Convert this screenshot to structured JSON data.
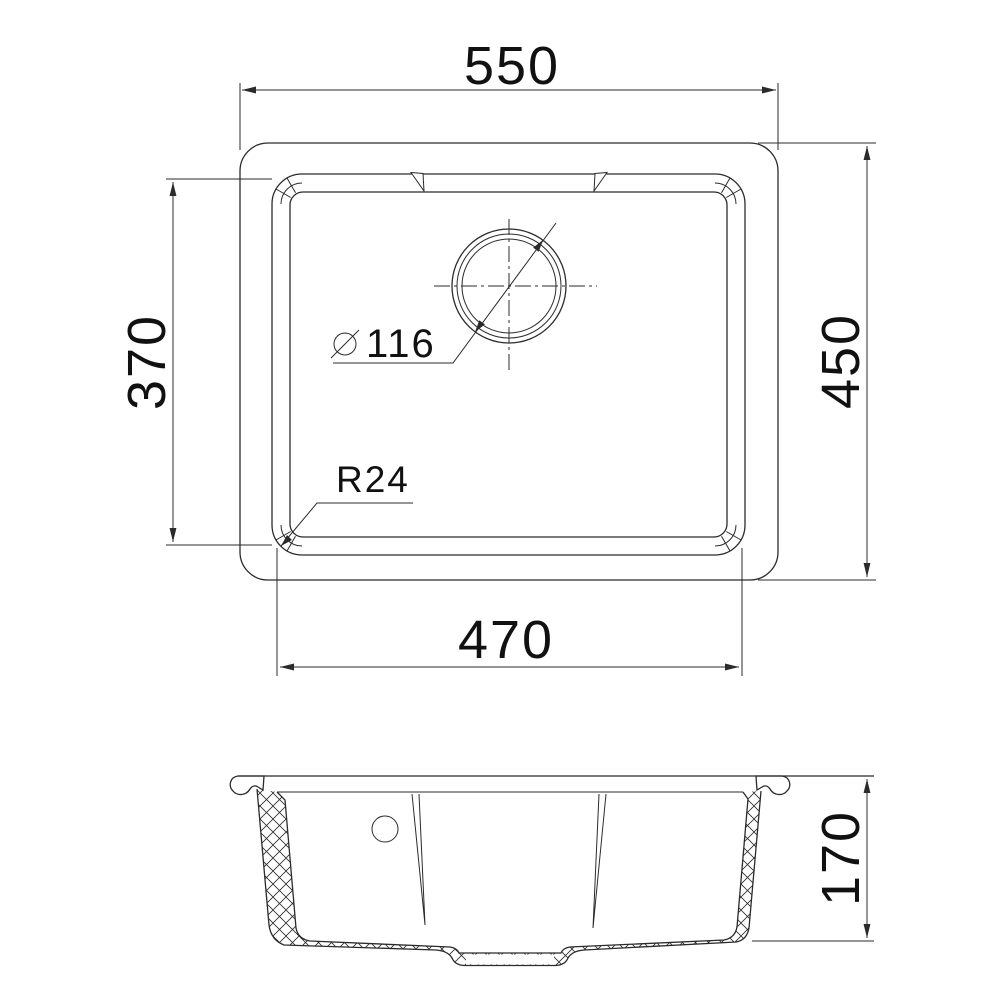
{
  "drawing": {
    "background": "#ffffff",
    "line_color": "#2b2b2b",
    "text_color": "#111111",
    "views": {
      "top_view": "plan view of sink",
      "section_view": "cross-section of sink"
    },
    "dimensions": {
      "overall_width": "550",
      "overall_depth": "450",
      "bowl_inner_depth": "370",
      "bowl_inner_width": "470",
      "drain_hole_diameter": "116",
      "corner_radius": "R24",
      "section_height": "170"
    }
  }
}
